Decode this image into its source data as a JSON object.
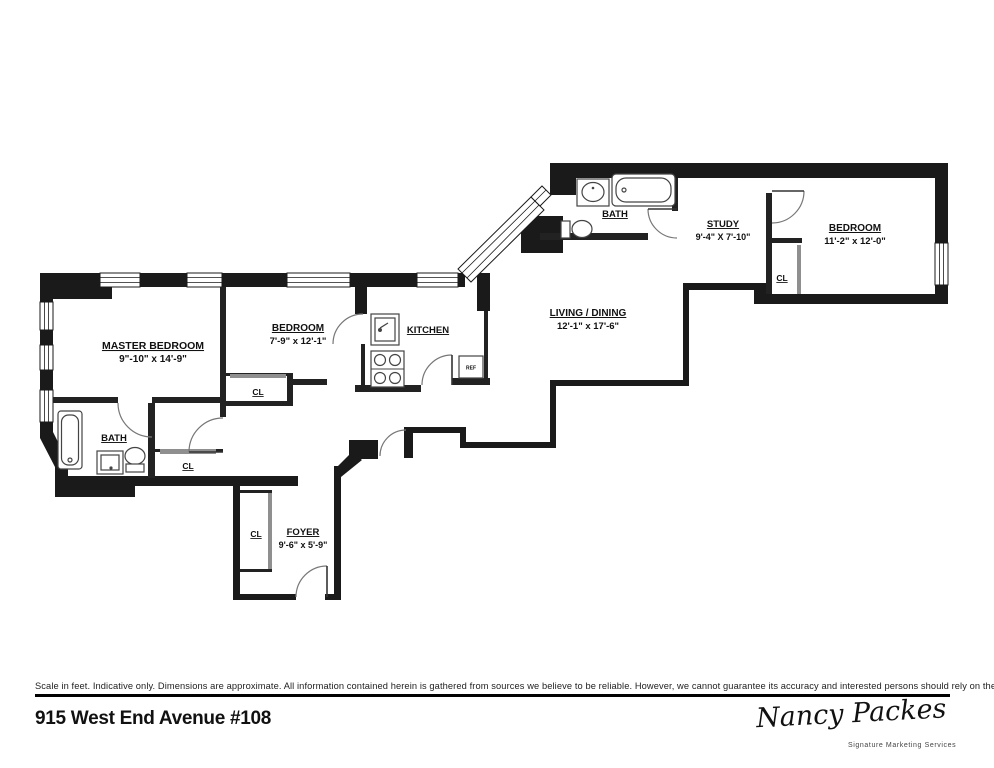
{
  "plan": {
    "rooms": {
      "master_bedroom": {
        "name": "MASTER BEDROOM",
        "dims": "9\"-10\" x 14'-9\""
      },
      "bedroom_mid": {
        "name": "BEDROOM",
        "dims": "7'-9\" x 12'-1\""
      },
      "bedroom_right": {
        "name": "BEDROOM",
        "dims": "11'-2\" x 12'-0\""
      },
      "study": {
        "name": "STUDY",
        "dims": "9'-4\" X 7'-10\""
      },
      "living_dining": {
        "name": "LIVING / DINING",
        "dims": "12'-1\" x 17'-6\""
      },
      "foyer": {
        "name": "FOYER",
        "dims": "9'-6\" x 5'-9\""
      },
      "kitchen": {
        "name": "KITCHEN"
      },
      "bath_lower": {
        "name": "BATH"
      },
      "bath_upper": {
        "name": "BATH"
      }
    },
    "labels": {
      "closet": "CL",
      "fridge": "REF"
    },
    "colors": {
      "wall": "#1a1a1a",
      "slider": "#8f8f8f"
    }
  },
  "footer": {
    "disclaimer": "Scale in feet. Indicative only. Dimensions are approximate. All information contained herein is gathered from sources we believe to be reliable. However, we cannot guarantee its accuracy and interested persons should rely on their own inquiries.",
    "address": "915 West End Avenue #108"
  },
  "branding": {
    "signature": "Nancy Packes",
    "tagline": "Signature Marketing Services"
  }
}
